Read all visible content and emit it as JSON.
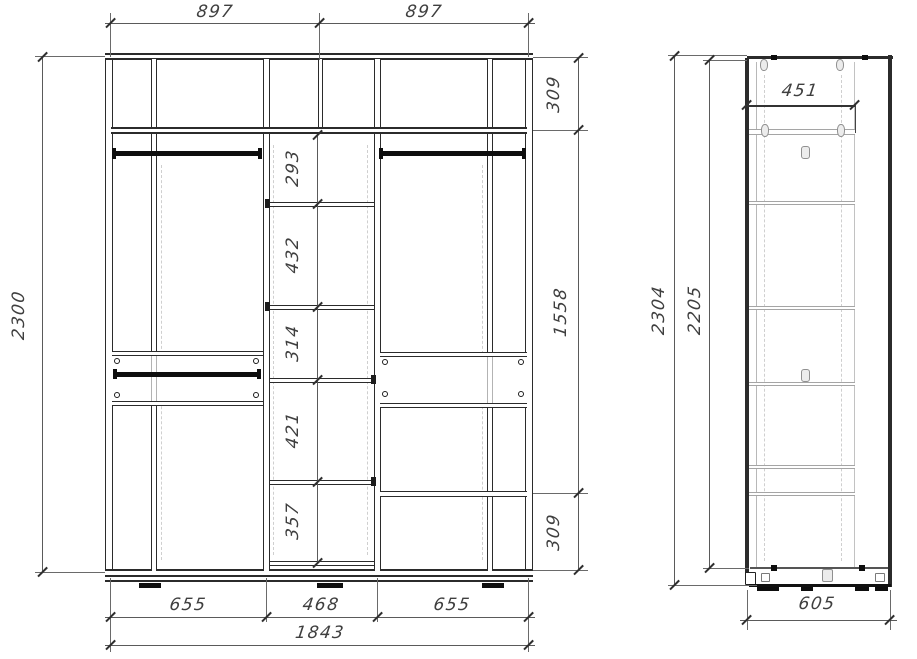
{
  "drawing_type": "wardrobe cabinet dimensioned technical drawing",
  "front": {
    "dims": {
      "top_left": "897",
      "top_right": "897",
      "height": "2300",
      "right_top": "309",
      "right_mid": "1558",
      "right_bottom": "309",
      "shelves": [
        "293",
        "432",
        "314",
        "421",
        "357"
      ],
      "bottom_left": "655",
      "bottom_center": "468",
      "bottom_right": "655",
      "total_width": "1843"
    }
  },
  "side": {
    "dims": {
      "inner_depth": "451",
      "height_total": "2304",
      "height_inner": "2205",
      "depth": "605"
    }
  },
  "colors": {
    "line": "#2b2b2b",
    "rod": "#0e0e0e",
    "light_line": "#b3b3b3",
    "dim_text": "#3f3f3f",
    "background": "#ffffff"
  }
}
